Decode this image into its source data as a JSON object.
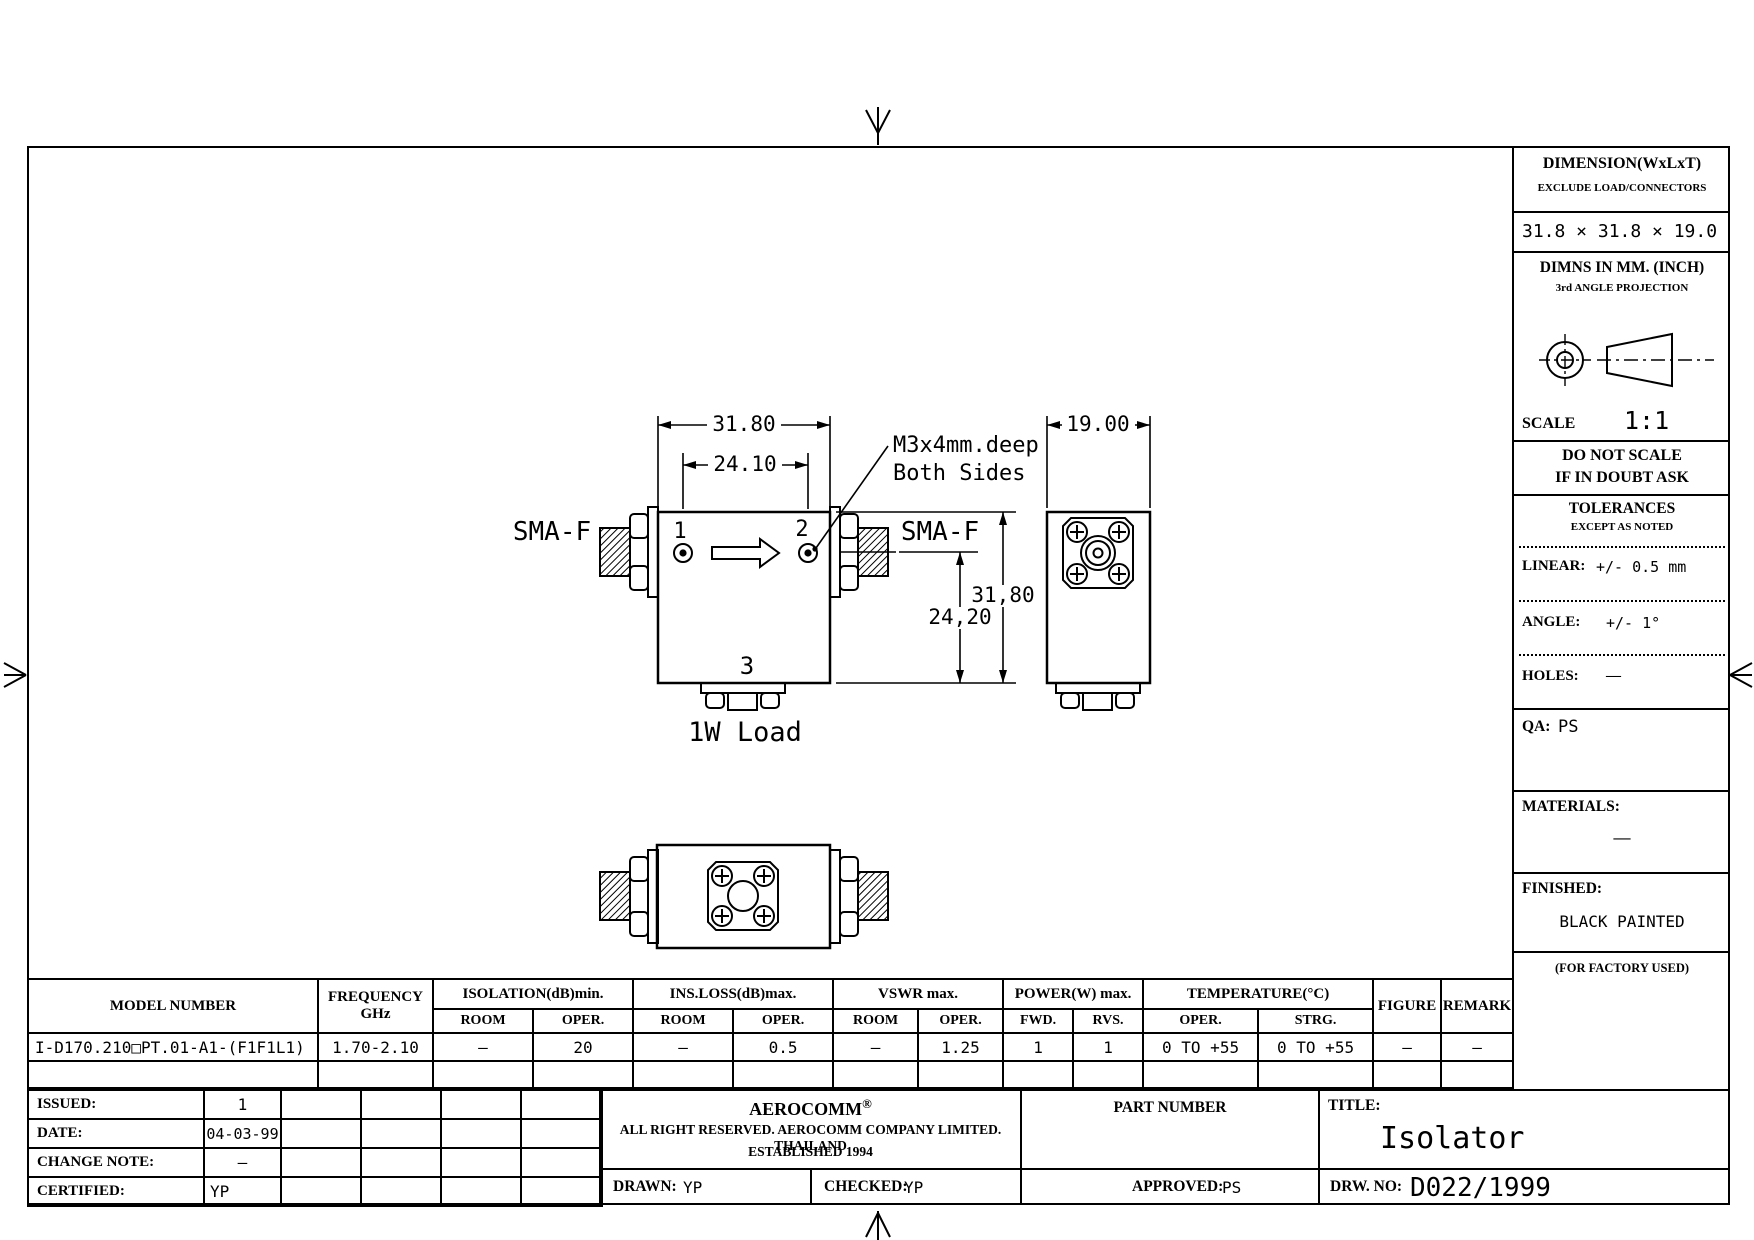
{
  "title_block": {
    "dimension_label": "DIMENSION(WxLxT)",
    "dimension_note": "EXCLUDE LOAD/CONNECTORS",
    "dimension_value": "31.8 × 31.8 × 19.0",
    "dimns_label": "DIMNS IN MM. (INCH)",
    "projection_label": "3rd ANGLE PROJECTION",
    "scale_label": "SCALE",
    "scale_value": "1:1",
    "do_not_scale_line1": "DO NOT SCALE",
    "do_not_scale_line2": "IF IN DOUBT ASK",
    "tolerances_title": "TOLERANCES",
    "tolerances_sub": "EXCEPT AS NOTED",
    "linear_label": "LINEAR:",
    "linear_value": "+/- 0.5 mm",
    "angle_label": "ANGLE:",
    "angle_value": "+/- 1°",
    "holes_label": "HOLES:",
    "holes_value": "—",
    "qa_label": "QA:",
    "qa_value": "PS",
    "materials_label": "MATERIALS:",
    "materials_value": "—",
    "finished_label": "FINISHED:",
    "finished_value": "BLACK PAINTED",
    "factory_note": "(FOR FACTORY USED)"
  },
  "drawing": {
    "dim_width": "31.80",
    "dim_ports": "24.10",
    "dim_depth": "19.00",
    "dim_height": "31,80",
    "dim_port_height": "24,20",
    "note_line1": "M3x4mm.deep",
    "note_line2": "Both Sides",
    "sma_left": "SMA-F",
    "sma_right": "SMA-F",
    "port1": "1",
    "port2": "2",
    "port3": "3",
    "load_label": "1W Load"
  },
  "spec_table": {
    "headers": {
      "model_number": "MODEL NUMBER",
      "frequency": "FREQUENCY",
      "frequency_unit": "GHz",
      "isolation": "ISOLATION(dB)min.",
      "ins_loss": "INS.LOSS(dB)max.",
      "vswr": "VSWR max.",
      "power": "POWER(W) max.",
      "temperature": "TEMPERATURE(°C)",
      "room": "ROOM",
      "oper": "OPER.",
      "fwd": "FWD.",
      "rvs": "RVS.",
      "strg": "STRG.",
      "figure": "FIGURE",
      "remark": "REMARK"
    },
    "row": {
      "model": "I-D170.210□PT.01-A1-(F1F1L1)",
      "frequency": "1.70-2.10",
      "isolation_room": "–",
      "isolation_oper": "20",
      "ins_loss_room": "–",
      "ins_loss_oper": "0.5",
      "vswr_room": "–",
      "vswr_oper": "1.25",
      "power_fwd": "1",
      "power_rvs": "1",
      "temp_oper": "0 TO +55",
      "temp_strg": "0 TO +55",
      "figure": "—",
      "remark": "—"
    }
  },
  "footer": {
    "issued_label": "ISSUED:",
    "issued_value": "1",
    "date_label": "DATE:",
    "date_value": "04-03-99",
    "change_note_label": "CHANGE NOTE:",
    "change_note_value": "–",
    "certified_label": "CERTIFIED:",
    "certified_value": "YP",
    "company_name": "AEROCOMM",
    "company_reg": "®",
    "company_line2": "ALL RIGHT RESERVED. AEROCOMM COMPANY LIMITED. THAILAND",
    "company_line3": "ESTABLISHED 1994",
    "part_number_label": "PART NUMBER",
    "title_label": "TITLE:",
    "title_value": "Isolator",
    "drawn_label": "DRAWN:",
    "drawn_value": "YP",
    "checked_label": "CHECKED:",
    "checked_value": "YP",
    "approved_label": "APPROVED:",
    "approved_value": "PS",
    "drw_no_label": "DRW. NO:",
    "drw_no_value": "D022/1999"
  }
}
